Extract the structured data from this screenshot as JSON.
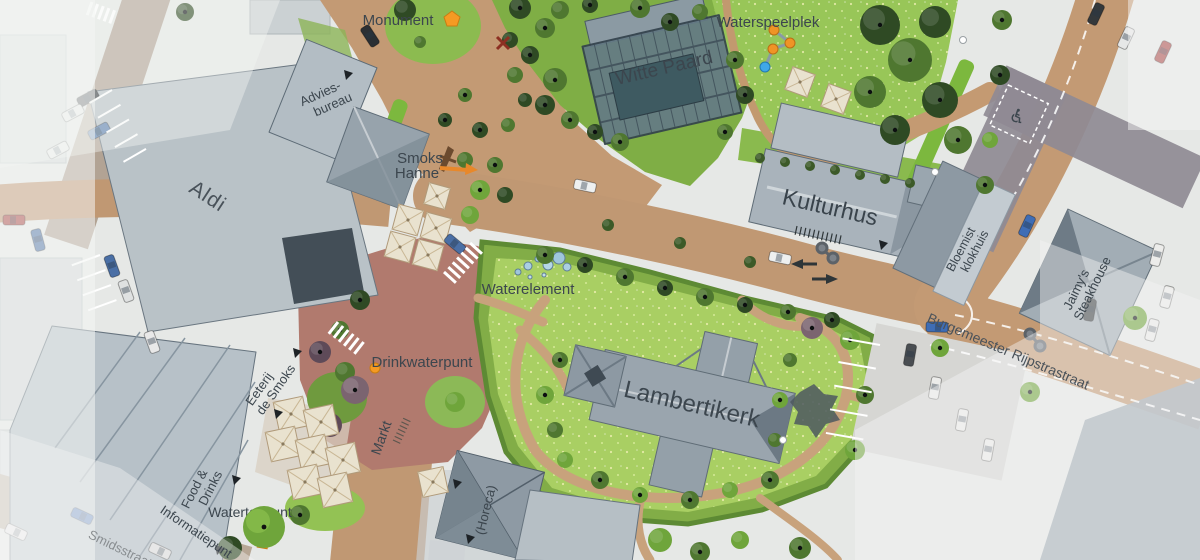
{
  "map": {
    "type": "urban-masterplan-top-view",
    "language": "Dutch",
    "labels": {
      "monument": "Monument",
      "waterspeelplek": "Waterspeelplek",
      "witte_paard": "Witte Paard",
      "advies_line1": "Advies-",
      "advies_line2": "bureau",
      "aldi": "Aldi",
      "smoks_line1": "Smoks",
      "smoks_line2": "Hanne",
      "kulturhus": "Kulturhus",
      "bloemist_line1": "Bloemist",
      "bloemist_line2": "klokhuis",
      "jaimys_line1": "Jaimy's",
      "jaimys_line2": "Steakhouse",
      "burgemeester": "Burgemeester Rijpstrastraat",
      "waterelement": "Waterelement",
      "drinkwaterpunt": "Drinkwaterpunt",
      "eeterij_line1": "Eeterij",
      "eeterij_line2": "de Smoks",
      "markt": "Markt",
      "lambertikerk": "Lambertikerk",
      "food_line1": "Food &",
      "food_line2": "Drinks",
      "informatiepunt": "Informatiepunt",
      "watertappunt": "Watertappunt",
      "horeca": "(Horeca)",
      "smidsstraat": "Smidsstraat",
      "disabled_parking_symbol": "♿"
    },
    "markers": {
      "monument_marker": {
        "shape": "pentagon",
        "color": "#f59a23",
        "x": 452,
        "y": 19
      },
      "drinkwaterpunt_marker": {
        "shape": "dot",
        "color": "#f59a23",
        "x": 375,
        "y": 368
      },
      "watertappunt_marker": {
        "shape": "square",
        "color": "#f59a23",
        "x": 263,
        "y": 543
      },
      "waterspeelplek_route": {
        "dot_color": "#ef9426",
        "end_dot_color": "#3fa8e8",
        "points": [
          [
            774,
            30
          ],
          [
            790,
            43
          ],
          [
            773,
            49
          ],
          [
            765,
            67
          ]
        ]
      },
      "closed_cross_marker": {
        "shape": "x",
        "color": "#8c2f22",
        "x": 503,
        "y": 43
      }
    },
    "palette": {
      "brick_road": "#c39a74",
      "plaza_red": "#b17a6e",
      "lawn_bright": "#a9cf63",
      "lawn_mid": "#82ad47",
      "roof_gray": "#a4afb7",
      "roof_dark": "#6e7b86",
      "glass_structure": "#647a85",
      "context_fade": "#f3f4f3",
      "accent_orange": "#f59a23"
    }
  }
}
